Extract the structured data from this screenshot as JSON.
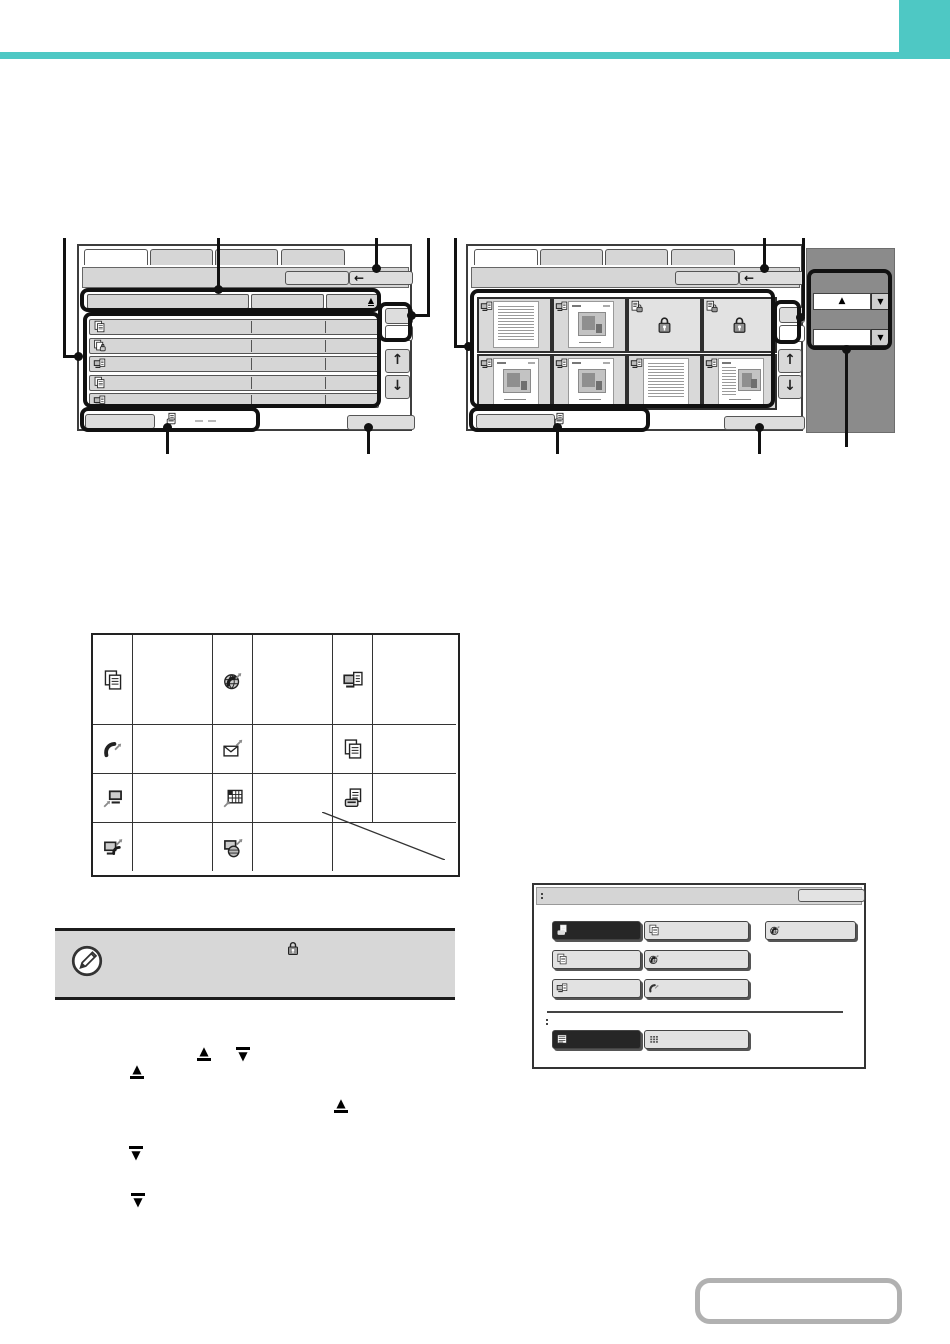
{
  "glyphs": {
    "back": "←",
    "up": "↑",
    "down": "↓",
    "sort_up": "▲",
    "drop_down": "▼"
  },
  "colors": {
    "accent_teal": "#4ec8c4",
    "callout_black": "#111111",
    "screen_button_gray": "#d6d6d6",
    "side_panel_gray": "#8b8b8b",
    "selected_button_dark": "#262626"
  },
  "file_list_screen": {
    "tabs": [
      "",
      "",
      "",
      ""
    ],
    "toolbar_buttons": [
      {
        "label": ""
      },
      {
        "label": "",
        "icon": "back-arrow-icon"
      }
    ],
    "header_columns": [
      {
        "label": ""
      },
      {
        "label": ""
      },
      {
        "label": "",
        "icon": "sort-ascending-icon"
      }
    ],
    "file_rows": [
      {
        "job_icon": "copy-job-icon"
      },
      {
        "job_icon": "copy-job-locked-icon"
      },
      {
        "job_icon": "scan-to-hdd-job-icon"
      },
      {
        "job_icon": "copy-job-icon"
      },
      {
        "job_icon": "scan-to-hdd-job-icon"
      }
    ],
    "scroll_buttons": [
      "scroll-up",
      "scroll-down"
    ],
    "bottom_bar": {
      "left_button": "",
      "icon": "document-print-icon",
      "right_button": ""
    }
  },
  "thumbnail_screen": {
    "tabs": [
      "",
      "",
      "",
      ""
    ],
    "toolbar_buttons": [
      {
        "label": ""
      },
      {
        "label": "",
        "icon": "back-arrow-icon"
      }
    ],
    "thumbnails": [
      {
        "corner_icon": "scan-to-hdd-job-icon",
        "content": "text-document"
      },
      {
        "corner_icon": "scan-to-hdd-job-icon",
        "content": "brochure-document"
      },
      {
        "corner_icon": "confidential-file-icon",
        "content": "locked"
      },
      {
        "corner_icon": "confidential-file-icon",
        "content": "locked"
      },
      {
        "corner_icon": "scan-to-hdd-job-icon",
        "content": "brochure-document"
      },
      {
        "corner_icon": "scan-to-hdd-job-icon",
        "content": "brochure-document"
      },
      {
        "corner_icon": "scan-to-hdd-job-icon",
        "content": "text-document"
      },
      {
        "corner_icon": "scan-to-hdd-job-icon",
        "content": "brochure-mixed-document"
      }
    ],
    "side_panel": {
      "field1_glyph": "▲",
      "field2_glyph": "",
      "dropdown_icon": "▼"
    },
    "bottom_bar": {
      "left_button": "",
      "icon": "document-print-icon",
      "right_button": ""
    }
  },
  "job_type_icon_table": {
    "rows": [
      [
        {
          "icon": "copy-job-icon"
        },
        {
          "icon": "internet-fax-job-icon"
        },
        {
          "icon": "scan-to-hdd-job-icon"
        }
      ],
      [
        {
          "icon": "fax-job-icon"
        },
        {
          "icon": "scan-to-email-job-icon"
        },
        {
          "icon": "copy-combined-job-icon"
        }
      ],
      [
        {
          "icon": "print-job-icon"
        },
        {
          "icon": "list-print-job-icon"
        },
        {
          "icon": "document-print-job-icon"
        }
      ],
      [
        {
          "icon": "pc-fax-job-icon"
        },
        {
          "icon": "pc-internet-fax-job-icon"
        },
        {
          "icon": "empty-diagonal-cell"
        }
      ]
    ]
  },
  "note_box": {
    "marker_icon": "pencil-note-icon",
    "inline_icon": "confidential-lock-icon"
  },
  "body_inline_icons": [
    "sort-up-underlined",
    "sort-down-overlined",
    "sort-up-underlined",
    "sort-up-underlined",
    "sort-down-overlined",
    "sort-down-overlined"
  ],
  "job_select_dialog": {
    "title_label": "",
    "title_button": "",
    "job_buttons": [
      {
        "state": "selected",
        "icon": "document-filing-print-icon"
      },
      {
        "state": "normal",
        "icon": "document-icon"
      },
      {
        "state": "normal",
        "icon": "internet-fax-icon"
      },
      {
        "state": "normal",
        "icon": "copy-icon"
      },
      {
        "state": "normal",
        "icon": "fax-globe-icon"
      },
      {
        "state": "normal",
        "icon": "scan-icon"
      },
      {
        "state": "normal",
        "icon": "phone-fax-icon"
      }
    ],
    "view_buttons": [
      {
        "state": "selected",
        "icon": "list-view-icon"
      },
      {
        "state": "normal",
        "icon": "thumbnail-view-icon"
      }
    ]
  },
  "contents_button": {
    "label": ""
  }
}
